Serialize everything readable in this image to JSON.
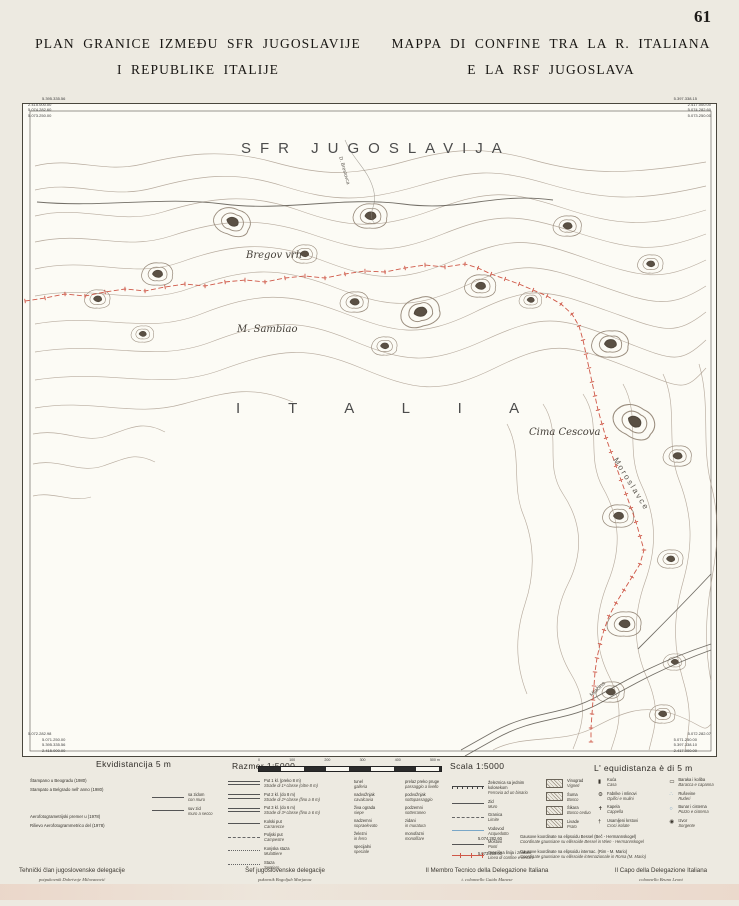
{
  "page": {
    "number": "61"
  },
  "titles": {
    "left1": "PLAN GRANICE IZMEĐU SFR JUGOSLAVIJE",
    "left2": "I REPUBLIKE ITALIJE",
    "right1": "MAPPA DI CONFINE TRA LA R. ITALIANA",
    "right2": "E LA RSF JUGOSLAVA"
  },
  "map": {
    "country1": "SFR JUGOSLAVIJA",
    "country2": "I T A L I A",
    "places": [
      "Bregov vrh",
      "M. Sambiao",
      "Cima Cescova",
      "Moroslavce",
      "D. Brestovca",
      "Mlačina"
    ],
    "boundary_color": "#cf5848",
    "corners": {
      "tl": [
        "5.395.335.56",
        "2.415.000.00",
        "5.074.282.60",
        "5.073.250.00"
      ],
      "tr": [
        "5.397.338.15",
        "2.417.000.00",
        "5.074.282.60",
        "5.073.250.00"
      ],
      "bl": [
        "5.072.282.98",
        "5.071.250.00",
        "5.395.335.56",
        "2.415.000.00"
      ],
      "br": [
        "5.072.282.07",
        "5.071.250.00",
        "5.397.338.10",
        "2.417.000.00"
      ]
    }
  },
  "legend": {
    "equidistance_left": "Ekvidistancija 5 m",
    "equidistance_right": "L' equidistanza è di 5 m",
    "scale_left": "Razmer 1:5000",
    "scale_right": "Scala 1:5000",
    "scale_ticks": [
      "0",
      "100",
      "200",
      "300",
      "400",
      "500 m"
    ],
    "print_notes": [
      "Štampano u Beogradu (1980)",
      "Stampato a Belgrado nell' anno (1980)"
    ],
    "survey_notes": [
      "Aerofotogrametrijski premer u (1978)",
      "Rilievo Aerofotogrammetrico del (1978)"
    ],
    "wall_samples": [
      {
        "sr": "sa zidom",
        "it": "con muro"
      },
      {
        "sr": "suv zid",
        "it": "muro a secco"
      }
    ],
    "roads": [
      {
        "sr": "Put 1 kl. (preko 8 m)",
        "it": "Strade di 1ª classe (oltre 8 m)",
        "style": "double"
      },
      {
        "sr": "Put 2 kl. (do 8 m)",
        "it": "Strade di 2ª classe (fino a 8 m)",
        "style": "double"
      },
      {
        "sr": "Put 3 kl. (do 6 m)",
        "it": "Strade di 3ª classe (fino a 6 m)",
        "style": "double"
      },
      {
        "sr": "Kolski put",
        "it": "Carrarecce",
        "style": "single"
      },
      {
        "sr": "Poljski put",
        "it": "Campestre",
        "style": "dashed"
      },
      {
        "sr": "Konjska staza",
        "it": "Mulattiere",
        "style": "dotted"
      },
      {
        "sr": "Staza",
        "it": "Sentiero",
        "style": "dotted"
      }
    ],
    "crossings": [
      {
        "sr": "tunel",
        "it": "galleria"
      },
      {
        "sr": "prelaz preko pruge",
        "it": "passaggio a livello"
      },
      {
        "sr": "nadvožnjak",
        "it": "cavalcavia"
      },
      {
        "sr": "podvožnjak",
        "it": "sottopassaggio"
      },
      {
        "sr": "živa ograda",
        "it": "siepe"
      },
      {
        "sr": "podzemni",
        "it": "sotterraneo"
      },
      {
        "sr": "nadzemni",
        "it": "sopraelevato"
      },
      {
        "sr": "zidani",
        "it": "in muratura"
      },
      {
        "sr": "železni",
        "it": "in ferro"
      },
      {
        "sr": "monofazni",
        "it": "monofilare"
      },
      {
        "sr": "specijalni",
        "it": "speciale"
      }
    ],
    "features": [
      {
        "sr": "Železnica sa jednim kolosekom",
        "it": "Ferrovia ad un binario",
        "style": "rail"
      },
      {
        "sr": "Zid",
        "it": "Muro",
        "style": "single"
      },
      {
        "sr": "Granica",
        "it": "Limite",
        "style": "dashed"
      },
      {
        "sr": "Vodovod",
        "it": "Acquedotto",
        "style": "blue"
      },
      {
        "sr": "Mostovi",
        "it": "Ponti",
        "style": "single"
      }
    ],
    "boundary_row": {
      "sr": "Granična linija i znakovi",
      "it": "Linea di confine e termini"
    },
    "areas": [
      {
        "sr": "Vinograd",
        "it": "Vigneti"
      },
      {
        "sr": "Šuma",
        "it": "Bosco"
      },
      {
        "sr": "Šikara",
        "it": "Bosco ceduo"
      },
      {
        "sr": "Livade",
        "it": "Prato"
      }
    ],
    "points": [
      {
        "sr": "Kuća",
        "it": "Casa",
        "g": "▮"
      },
      {
        "sr": "Fabrike i mlinovi",
        "it": "Opifici e mulini",
        "g": "⚙"
      },
      {
        "sr": "Kapela",
        "it": "Cappella",
        "g": "✝"
      },
      {
        "sr": "Usamljeni krstovi",
        "it": "Croci isolate",
        "g": "†"
      },
      {
        "sr": "Baraka i koliba",
        "it": "Baracca e capanna",
        "g": "▭"
      },
      {
        "sr": "Ruševine",
        "it": "Ruderi",
        "g": "∴"
      },
      {
        "sr": "Bunar i cisterna",
        "it": "Pozzo e cisterna",
        "g": "○"
      },
      {
        "sr": "Izvor",
        "it": "Sorgente",
        "g": "◉"
      }
    ],
    "coordinate_notes": [
      {
        "value": "5.074.282.60",
        "sr": "Gausove koordinate na elipsoidu Bessel (Beč - Hermannskogel)",
        "it": "Coordinate gaussiane su ellissoide Bessel in Wien - Hermannskogel"
      },
      {
        "value": "5.073.250.00",
        "sr": "Gausove koordinate na elipsoidu internac. (Rim - M. Mario)",
        "it": "Coordinate gaussiane su ellissoide internazionale in Roma (M. Mario)"
      }
    ]
  },
  "signatures": [
    {
      "role": "Tehnički član jugoslovenske delegacije",
      "name": "potpukovnik Dobrivoje Milovanović"
    },
    {
      "role": "Šef jugoslovenske delegacije",
      "name": "pukovnik Bogoljub Marjanac"
    },
    {
      "role": "Il Membro Tecnico della Delegazione Italiana",
      "name": "t. colonnello Guido Manese"
    },
    {
      "role": "Il Capo della Delegazione Italiana",
      "name": "colonnello Bruno Leoni"
    }
  ]
}
